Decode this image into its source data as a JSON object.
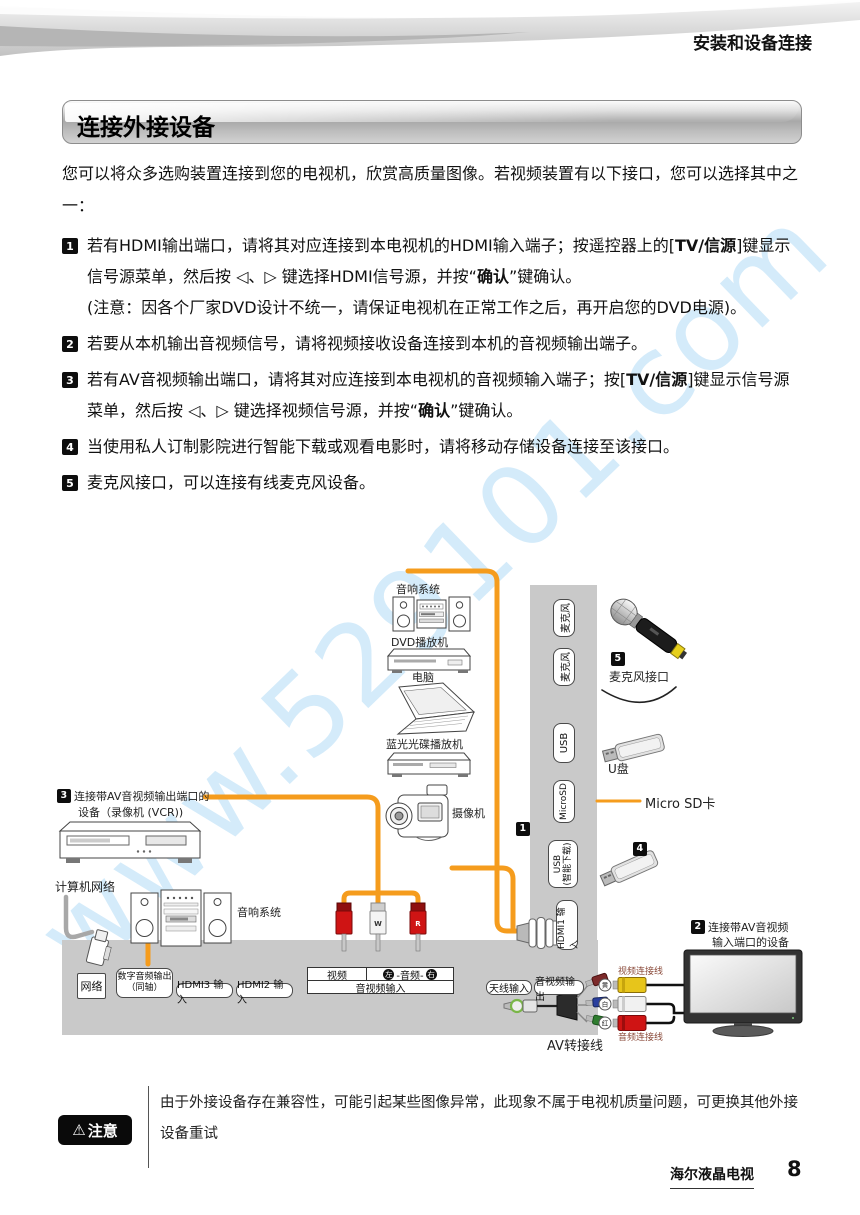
{
  "header": {
    "title": "安装和设备连接"
  },
  "section": {
    "title": "连接外接设备"
  },
  "watermark": {
    "text": "www.529101.com"
  },
  "colors": {
    "accent_orange": "#F59C1D",
    "panel_gray": "#C9C9C9",
    "badge_black": "#0D0D0D"
  },
  "body": {
    "intro": "您可以将众多选购装置连接到您的电视机，欣赏高质量图像。若视频装置有以下接口，您可以选择其中之一：",
    "items": [
      {
        "num": "1",
        "segments": [
          {
            "t": "若有HDMI输出端口，请将其对应连接到本电视机的HDMI输入端子；按遥控器上的["
          },
          {
            "t": "TV/信源",
            "b": true
          },
          {
            "t": "]键显示信号源菜单，然后按 ◁、▷ 键选择HDMI信号源，并按“"
          },
          {
            "t": "确认",
            "b": true
          },
          {
            "t": "”键确认。"
          },
          {
            "t": "(注意：因各个厂家DVD设计不统一，请保证电视机在正常工作之后，再开启您的DVD电源)。",
            "br": true
          }
        ]
      },
      {
        "num": "2",
        "segments": [
          {
            "t": "若要从本机输出音视频信号，请将视频接收设备连接到本机的音视频输出端子。"
          }
        ]
      },
      {
        "num": "3",
        "segments": [
          {
            "t": "若有AV音视频输出端口，请将其对应连接到本电视机的音视频输入端子；按["
          },
          {
            "t": "TV/信源",
            "b": true
          },
          {
            "t": "]键显示信号源菜单，然后按 ◁、▷ 键选择视频信号源，并按“"
          },
          {
            "t": "确认",
            "b": true
          },
          {
            "t": "”键确认。"
          }
        ]
      },
      {
        "num": "4",
        "segments": [
          {
            "t": "当使用私人订制影院进行智能下载或观看电影时，请将移动存储设备连接至该接口。"
          }
        ]
      },
      {
        "num": "5",
        "segments": [
          {
            "t": "麦克风接口，可以连接有线麦克风设备。"
          }
        ]
      }
    ]
  },
  "diagram": {
    "badges": {
      "b1": "1",
      "b2": "2",
      "b3": "3",
      "b4": "4",
      "b5": "5"
    },
    "vports": [
      {
        "label": "麦克风"
      },
      {
        "label": "麦克风"
      },
      {
        "label": "USB"
      },
      {
        "label": "MicroSD"
      },
      {
        "label": "USB",
        "label2": "(智能下载)"
      },
      {
        "label": "HDMI1 输入"
      }
    ],
    "ports": {
      "network": "网络",
      "digital1": "数字音频输出",
      "digital2": "（同轴）",
      "hdmi3": "HDMI3 输入",
      "hdmi2": "HDMI2 输入",
      "antenna": "天线输入",
      "avout": "音视频输出"
    },
    "table": {
      "video": "视频",
      "left": "左",
      "audio": "-音频-",
      "right": "右",
      "av_input": "音视频输入"
    },
    "plugs": {
      "w": "W",
      "r": "R"
    },
    "rings": {
      "yellow": "黄",
      "white": "白",
      "red": "红"
    },
    "labels": {
      "audio_top": "音响系统",
      "dvd": "DVD播放机",
      "pc": "电脑",
      "bluray": "蓝光光碟播放机",
      "camcorder": "摄像机",
      "vcr_line1": "连接带AV音视频输出端口的",
      "vcr_line2": "设备（录像机 (VCR))",
      "computer_network": "计算机网络",
      "audio_bottom": "音响系统",
      "mic_port": "麦克风接口",
      "udisk": "U盘",
      "microsd_card": "Micro SD卡",
      "tv_line1": "连接带AV音视频",
      "tv_line2": "输入端口的设备",
      "video_cable": "视频连接线",
      "audio_cable": "音频连接线",
      "av_adapter": "AV转接线"
    }
  },
  "note": {
    "icon": "⚠",
    "label": "注意",
    "text": "由于外接设备存在兼容性，可能引起某些图像异常，此现象不属于电视机质量问题，可更换其他外接设备重试"
  },
  "footer": {
    "brand": "海尔液晶电视",
    "page": "8"
  }
}
